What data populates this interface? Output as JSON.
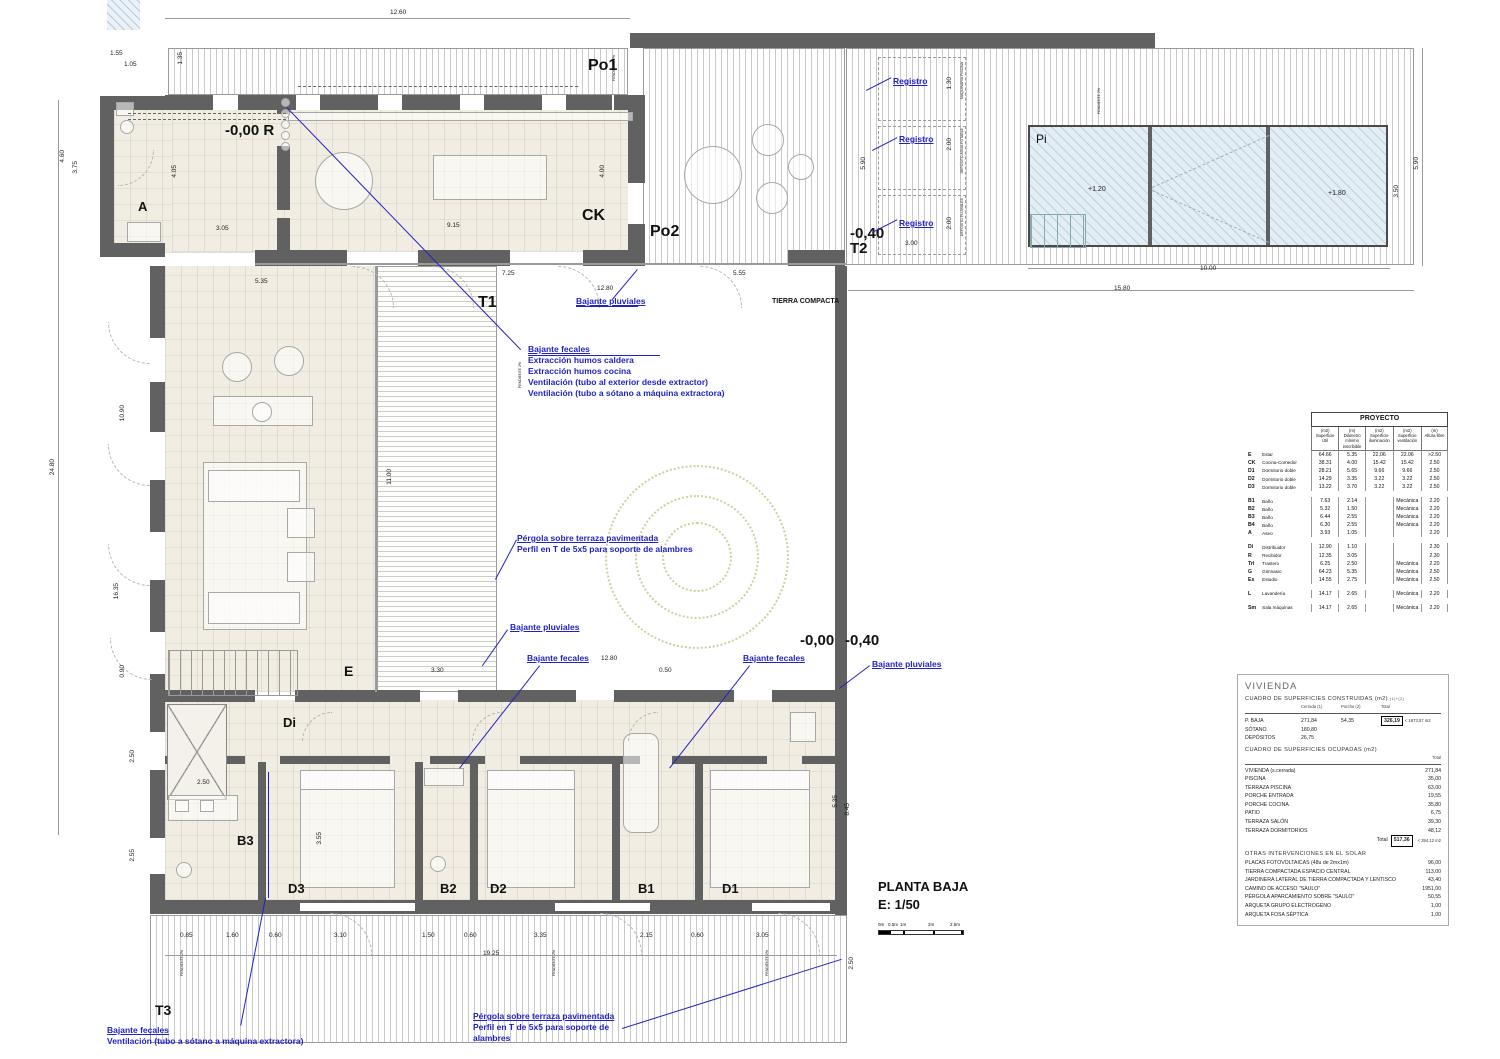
{
  "drawing": {
    "title": "PLANTA BAJA",
    "scale": "E: 1/50",
    "scale_bar": [
      "0m",
      "0.5m",
      "1m",
      "2m",
      "2.5m"
    ],
    "accent_blue": "#2222c4",
    "wall_gray": "#616161"
  },
  "plan": {
    "labels": [
      {
        "t": "Po1",
        "x": 588,
        "y": 58,
        "s": 16
      },
      {
        "t": "CK",
        "x": 582,
        "y": 208,
        "s": 16
      },
      {
        "t": "Po2",
        "x": 650,
        "y": 224,
        "s": 16
      },
      {
        "t": "-0,40",
        "x": 850,
        "y": 226,
        "s": 15
      },
      {
        "t": "T2",
        "x": 850,
        "y": 241,
        "s": 15
      },
      {
        "t": "Pi",
        "x": 1036,
        "y": 133,
        "s": 12,
        "b": 0
      },
      {
        "t": "A",
        "x": 138,
        "y": 200,
        "s": 13
      },
      {
        "t": "-0,00 R",
        "x": 225,
        "y": 123,
        "s": 15
      },
      {
        "t": "T1",
        "x": 478,
        "y": 295,
        "s": 16
      },
      {
        "t": "TIERRA COMPACTA",
        "x": 772,
        "y": 298,
        "s": 7
      },
      {
        "t": "E",
        "x": 344,
        "y": 664,
        "s": 14
      },
      {
        "t": "-0,00",
        "x": 800,
        "y": 633,
        "s": 15
      },
      {
        "t": "-0,40",
        "x": 845,
        "y": 633,
        "s": 15
      },
      {
        "t": "Di",
        "x": 283,
        "y": 716,
        "s": 13
      },
      {
        "t": "B3",
        "x": 237,
        "y": 834,
        "s": 13
      },
      {
        "t": "D3",
        "x": 288,
        "y": 882,
        "s": 13
      },
      {
        "t": "B2",
        "x": 440,
        "y": 882,
        "s": 13
      },
      {
        "t": "D2",
        "x": 490,
        "y": 882,
        "s": 13
      },
      {
        "t": "B1",
        "x": 638,
        "y": 882,
        "s": 13
      },
      {
        "t": "D1",
        "x": 722,
        "y": 882,
        "s": 13
      },
      {
        "t": "T3",
        "x": 155,
        "y": 1003,
        "s": 14
      }
    ],
    "dims": [
      {
        "t": "12.60",
        "x": 390,
        "y": 10
      },
      {
        "t": "1.55",
        "x": 110,
        "y": 51
      },
      {
        "t": "1.05",
        "x": 124,
        "y": 62
      },
      {
        "t": "1.35",
        "x": 178,
        "y": 52,
        "v": 1
      },
      {
        "t": "4.60",
        "x": 60,
        "y": 150,
        "v": 1
      },
      {
        "t": "3.75",
        "x": 73,
        "y": 161,
        "v": 1
      },
      {
        "t": "4.05",
        "x": 172,
        "y": 165,
        "v": 1
      },
      {
        "t": "3.05",
        "x": 216,
        "y": 226
      },
      {
        "t": "9.15",
        "x": 447,
        "y": 223
      },
      {
        "t": "4.00",
        "x": 600,
        "y": 165,
        "v": 1
      },
      {
        "t": "7.25",
        "x": 502,
        "y": 271
      },
      {
        "t": "12.80",
        "x": 597,
        "y": 286
      },
      {
        "t": "5.55",
        "x": 733,
        "y": 271
      },
      {
        "t": "5.90",
        "x": 861,
        "y": 157,
        "v": 1
      },
      {
        "t": "1.30",
        "x": 947,
        "y": 77,
        "v": 1
      },
      {
        "t": "2.00",
        "x": 947,
        "y": 138,
        "v": 1
      },
      {
        "t": "2.00",
        "x": 947,
        "y": 217,
        "v": 1
      },
      {
        "t": "3.00",
        "x": 905,
        "y": 241
      },
      {
        "t": "5.90",
        "x": 1414,
        "y": 157,
        "v": 1
      },
      {
        "t": "3.50",
        "x": 1394,
        "y": 185,
        "v": 1
      },
      {
        "t": "10.00",
        "x": 1200,
        "y": 266
      },
      {
        "t": "15.80",
        "x": 1114,
        "y": 286
      },
      {
        "t": "24.80",
        "x": 50,
        "y": 459,
        "v": 1
      },
      {
        "t": "10.90",
        "x": 120,
        "y": 405,
        "v": 1
      },
      {
        "t": "16.35",
        "x": 114,
        "y": 583,
        "v": 1
      },
      {
        "t": "0.90",
        "x": 120,
        "y": 665,
        "v": 1
      },
      {
        "t": "5.35",
        "x": 255,
        "y": 279
      },
      {
        "t": "11.00",
        "x": 387,
        "y": 469,
        "v": 1
      },
      {
        "t": "3.30",
        "x": 431,
        "y": 668
      },
      {
        "t": "12.80",
        "x": 601,
        "y": 656
      },
      {
        "t": "0.50",
        "x": 659,
        "y": 668
      },
      {
        "t": "2.50",
        "x": 130,
        "y": 750,
        "v": 1
      },
      {
        "t": "2.55",
        "x": 130,
        "y": 849,
        "v": 1
      },
      {
        "t": "2.50",
        "x": 197,
        "y": 780
      },
      {
        "t": "3.55",
        "x": 317,
        "y": 832,
        "v": 1
      },
      {
        "t": "5.35",
        "x": 833,
        "y": 795,
        "v": 1
      },
      {
        "t": "8.45",
        "x": 845,
        "y": 803,
        "v": 1
      },
      {
        "t": "0.85",
        "x": 180,
        "y": 933
      },
      {
        "t": "1.60",
        "x": 226,
        "y": 933
      },
      {
        "t": "0.60",
        "x": 269,
        "y": 933
      },
      {
        "t": "3.10",
        "x": 334,
        "y": 933
      },
      {
        "t": "1.50",
        "x": 422,
        "y": 933
      },
      {
        "t": "0.60",
        "x": 464,
        "y": 933
      },
      {
        "t": "3.35",
        "x": 534,
        "y": 933
      },
      {
        "t": "2.15",
        "x": 640,
        "y": 933
      },
      {
        "t": "0.60",
        "x": 691,
        "y": 933
      },
      {
        "t": "3.05",
        "x": 756,
        "y": 933
      },
      {
        "t": "19.25",
        "x": 483,
        "y": 951
      },
      {
        "t": "2.50",
        "x": 849,
        "y": 957,
        "v": 1
      },
      {
        "t": "+1.20",
        "x": 1088,
        "y": 186,
        "s": 7
      },
      {
        "t": "+1.80",
        "x": 1328,
        "y": 190,
        "s": 7
      },
      {
        "t": "MAQUINARIA PISCINA",
        "x": 961,
        "y": 62,
        "v": 1,
        "s": 3.5
      },
      {
        "t": "DEPÓSITO AGUA POTABLE",
        "x": 961,
        "y": 128,
        "v": 1,
        "s": 3.5
      },
      {
        "t": "DEPÓSITO PLUVIALES",
        "x": 961,
        "y": 198,
        "v": 1,
        "s": 3.5
      },
      {
        "t": "PENDIENTE 2%",
        "x": 613,
        "y": 55,
        "v": 1,
        "s": 3.5
      },
      {
        "t": "PENDIENTE 2%",
        "x": 519,
        "y": 362,
        "v": 1,
        "s": 3.5
      },
      {
        "t": "PENDIENTE 2%",
        "x": 1098,
        "y": 88,
        "v": 1,
        "s": 3.5
      },
      {
        "t": "PENDIENTE 2%",
        "x": 181,
        "y": 950,
        "v": 1,
        "s": 3.5
      },
      {
        "t": "PENDIENTE 2%",
        "x": 553,
        "y": 950,
        "v": 1,
        "s": 3.5
      },
      {
        "t": "PENDIENTE 2%",
        "x": 766,
        "y": 950,
        "v": 1,
        "s": 3.5
      }
    ],
    "blue_notes": [
      {
        "l": [
          "Bajante pluviales"
        ],
        "x": 576,
        "y": 296,
        "u": 1
      },
      {
        "l": [
          "Bajante fecales",
          "Extracción humos caldera",
          "Extracción humos cocina",
          "Ventilación (tubo al exterior desde extractor)",
          "Ventilación (tubo a sótano a máquina extractora)"
        ],
        "x": 528,
        "y": 344,
        "u": 1
      },
      {
        "l": [
          "Pérgola sobre terraza pavimentada",
          "Perfil en T de 5x5 para soporte de alambres"
        ],
        "x": 517,
        "y": 533,
        "u": 1
      },
      {
        "l": [
          "Bajante pluviales"
        ],
        "x": 510,
        "y": 622,
        "u": 1
      },
      {
        "l": [
          "Bajante fecales"
        ],
        "x": 527,
        "y": 653,
        "u": 1
      },
      {
        "l": [
          "Bajante fecales"
        ],
        "x": 743,
        "y": 653,
        "u": 1
      },
      {
        "l": [
          "Bajante pluviales"
        ],
        "x": 872,
        "y": 659,
        "u": 1
      },
      {
        "l": [
          "Registro"
        ],
        "x": 893,
        "y": 76,
        "u": 1
      },
      {
        "l": [
          "Registro"
        ],
        "x": 899,
        "y": 134,
        "u": 1
      },
      {
        "l": [
          "Registro"
        ],
        "x": 899,
        "y": 218,
        "u": 1
      },
      {
        "l": [
          "Bajante fecales",
          "Ventilación (tubo a sótano a máquina extractora)"
        ],
        "x": 107,
        "y": 1025,
        "u": 1
      },
      {
        "l": [
          "Pérgola sobre terraza pavimentada",
          "Perfil en T de 5x5 para soporte de",
          "alambres"
        ],
        "x": 473,
        "y": 1011,
        "u": 1
      }
    ],
    "leaders": [
      {
        "x": 287,
        "y": 107,
        "len": 337,
        "deg": 46
      },
      {
        "x": 612,
        "y": 299,
        "len": 39,
        "deg": -50
      },
      {
        "x": 528,
        "y": 355,
        "len": 132,
        "deg": 0
      },
      {
        "x": 576,
        "y": 306,
        "len": 62,
        "deg": 0
      },
      {
        "x": 517,
        "y": 540,
        "len": 45,
        "deg": 118
      },
      {
        "x": 508,
        "y": 630,
        "len": 44,
        "deg": 125
      },
      {
        "x": 540,
        "y": 666,
        "len": 130,
        "deg": 128
      },
      {
        "x": 750,
        "y": 666,
        "len": 130,
        "deg": 128
      },
      {
        "x": 870,
        "y": 666,
        "len": 38,
        "deg": 143
      },
      {
        "x": 269,
        "y": 772,
        "len": 126,
        "deg": 90
      },
      {
        "x": 266,
        "y": 898,
        "len": 130,
        "deg": 101
      },
      {
        "x": 622,
        "y": 1028,
        "len": 230,
        "deg": -17.5
      },
      {
        "x": 866,
        "y": 90,
        "len": 28,
        "deg": -27
      },
      {
        "x": 872,
        "y": 150,
        "len": 28,
        "deg": -27
      },
      {
        "x": 872,
        "y": 232,
        "len": 28,
        "deg": -27
      }
    ]
  },
  "proyecto_table": {
    "title": "PROYECTO",
    "col_headers": [
      [
        "(m2)",
        "Superficie",
        "Útil"
      ],
      [
        "(m)",
        "Diámetro",
        "mínimo",
        "inscribible"
      ],
      [
        "(m2)",
        "Superficie",
        "iluminación"
      ],
      [
        "(m2)",
        "Superficie",
        "ventilación"
      ],
      [
        "(m)",
        "Altura libre"
      ]
    ],
    "rows": [
      {
        "c": "E",
        "n": "Estar",
        "v": [
          "64.66",
          "5.35",
          "22.06",
          "22.06",
          ">2.50"
        ]
      },
      {
        "c": "CK",
        "n": "Cocina-Comedor",
        "v": [
          "38.31",
          "4.00",
          "15.42",
          "15.42",
          "2.50"
        ]
      },
      {
        "c": "D1",
        "n": "Dormitorio doble",
        "v": [
          "28.21",
          "5.65",
          "9.66",
          "9.66",
          "2.50"
        ]
      },
      {
        "c": "D2",
        "n": "Dormitorio doble",
        "v": [
          "14.29",
          "3.35",
          "3.22",
          "3.22",
          "2.50"
        ]
      },
      {
        "c": "D3",
        "n": "Dormitorio doble",
        "v": [
          "13.22",
          "3.70",
          "3.22",
          "3.22",
          "2.50"
        ]
      },
      {
        "gap": true
      },
      {
        "c": "B1",
        "n": "Baño",
        "v": [
          "7.63",
          "2.14",
          "",
          "Mecánica",
          "2.20"
        ]
      },
      {
        "c": "B2",
        "n": "Baño",
        "v": [
          "5.32",
          "1.50",
          "",
          "Mecánica",
          "2.20"
        ]
      },
      {
        "c": "B3",
        "n": "Baño",
        "v": [
          "6.44",
          "2.55",
          "",
          "Mecánica",
          "2.20"
        ]
      },
      {
        "c": "B4",
        "n": "Baño",
        "v": [
          "6.30",
          "2.55",
          "",
          "Mecánica",
          "2.20"
        ]
      },
      {
        "c": "A",
        "n": "Aseo",
        "v": [
          "3.93",
          "1.05",
          "",
          "",
          "2.20"
        ]
      },
      {
        "gap": true
      },
      {
        "c": "Di",
        "n": "Distribuidor",
        "v": [
          "12.90",
          "1.10",
          "",
          "",
          "2.30"
        ]
      },
      {
        "c": "R",
        "n": "Recibidor",
        "v": [
          "12.35",
          "3.05",
          "",
          "",
          "2.30"
        ]
      },
      {
        "c": "Trl",
        "n": "Trastero",
        "v": [
          "6.25",
          "2.50",
          "",
          "Mecánica",
          "2.20"
        ]
      },
      {
        "c": "G",
        "n": "Gimnasio",
        "v": [
          "64.23",
          "5.35",
          "",
          "Mecánica",
          "2.50"
        ]
      },
      {
        "c": "Es",
        "n": "Estudio",
        "v": [
          "14.55",
          "2.75",
          "",
          "Mecánica",
          "2.50"
        ]
      },
      {
        "gap": true
      },
      {
        "c": "L",
        "n": "Lavandería",
        "v": [
          "14.17",
          "2.65",
          "",
          "Mecánica",
          "2.20"
        ]
      },
      {
        "gap": true
      },
      {
        "c": "Sm",
        "n": "Sala máquinas",
        "v": [
          "14.17",
          "2.65",
          "",
          "Mecánica",
          "2.20"
        ]
      }
    ]
  },
  "vivienda_panel": {
    "title": "VIVIENDA",
    "constructed": {
      "heading": "CUADRO DE SUPERFICIES CONSTRUIDAS (m2)",
      "note": "(1)+(2)",
      "col_headers": [
        "Cerrada (1)",
        "Porche (2)",
        "Total"
      ],
      "rows": [
        {
          "label": "P. BAJA",
          "cerrada": "271,84",
          "porche": "54,35",
          "total": "326,19",
          "limit": "< 1873,57 m2"
        },
        {
          "label": "SÓTANO",
          "cerrada": "180,80"
        },
        {
          "label": "DEPÓSITOS",
          "cerrada": "26,75"
        }
      ]
    },
    "occupied": {
      "heading": "CUADRO DE SUPERFICIES OCUPADAS (m2)",
      "col_header": "Total",
      "rows": [
        {
          "label": "VIVIENDA (s.cerrada)",
          "value": "271,84"
        },
        {
          "label": "PISCINA",
          "value": "35,00"
        },
        {
          "label": "TERRAZA PISCINA",
          "value": "63,00"
        },
        {
          "label": "PORCHE ENTRADA",
          "value": "19,55"
        },
        {
          "label": "PORCHE COCINA",
          "value": "35,80"
        },
        {
          "label": "PATIO",
          "value": "6,75"
        },
        {
          "label": "TERRAZA SALÓN",
          "value": "39,30"
        },
        {
          "label": "TERRAZA DORMITORIOS",
          "value": "48,12"
        }
      ],
      "total_label": "Total",
      "total": "517,36",
      "limit": "< 394,12 m2"
    },
    "other": {
      "heading": "OTRAS INTERVENCIONES EN EL SOLAR",
      "rows": [
        {
          "label": "PLACAS FOTOVOLTAICAS (48u de 2mx1m)",
          "value": "96,00"
        },
        {
          "label": "TIERRA COMPACTADA ESPACIO CENTRAL",
          "value": "113,00"
        },
        {
          "label": "JARDINERA LATERAL DE TIERRA COMPACTADA Y LENTISCO",
          "value": "43,40"
        },
        {
          "label": "CAMINO DE ACCESO \"SAULO\"",
          "value": "1951,00"
        },
        {
          "label": "PÉRGOLA APARCAMIENTO SOBRE \"SAULO\"",
          "value": "50,55"
        },
        {
          "label": "ARQUETA GRUPO ELECTROGENO",
          "value": "1,00"
        },
        {
          "label": "ARQUETA FOSA SÉPTICA",
          "value": "1,00"
        }
      ]
    }
  }
}
